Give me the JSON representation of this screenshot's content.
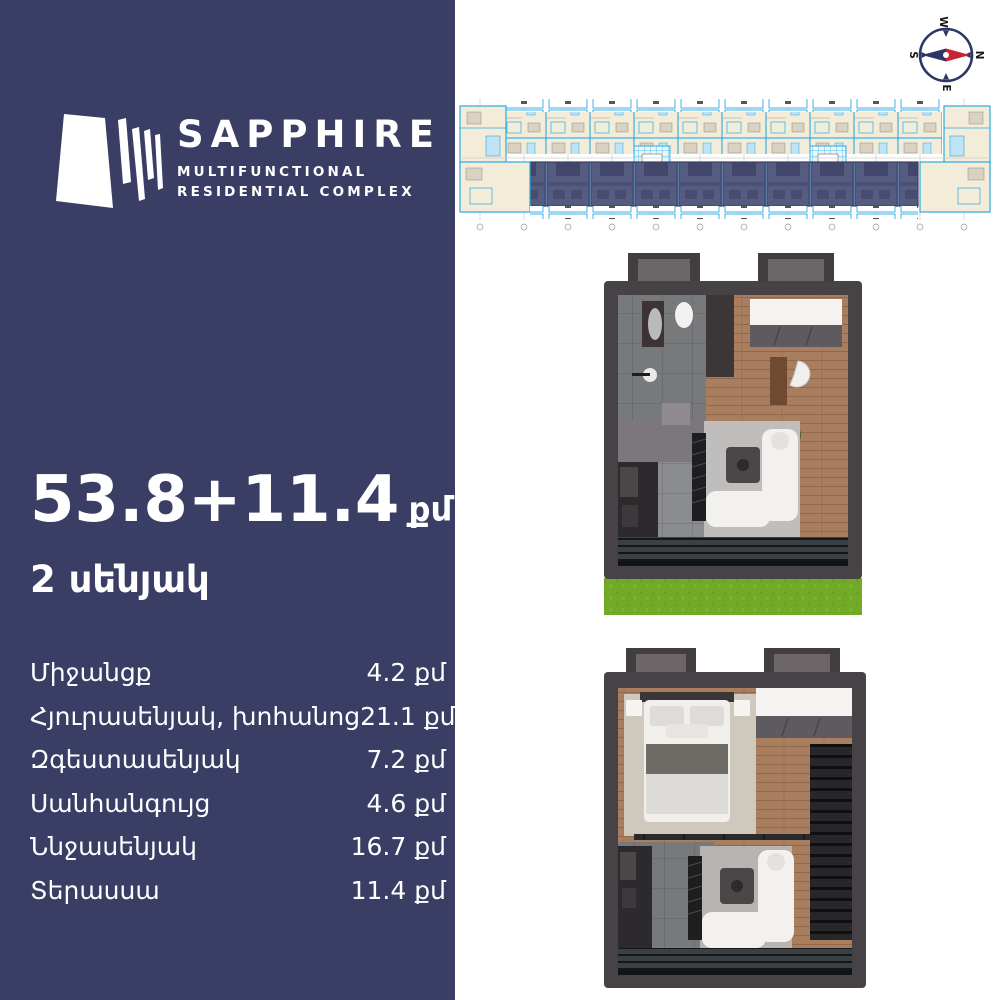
{
  "brand": {
    "name": "SAPPHIRE",
    "tagline1": "MULTIFUNCTIONAL",
    "tagline2": "RESIDENTIAL COMPLEX"
  },
  "listing": {
    "area_value": "53.8+11.4",
    "area_unit": "քմ",
    "rooms": "2 սենյակ"
  },
  "room_list": [
    {
      "label": "Միջանցք",
      "value": "4.2 քմ"
    },
    {
      "label": "Հյուրասենյակ, խոհանոց",
      "value": "21.1 քմ"
    },
    {
      "label": "Զգեստասենյակ",
      "value": "7.2 քմ"
    },
    {
      "label": "Սանհանգույց",
      "value": "4.6 քմ"
    },
    {
      "label": "Ննջասենյակ",
      "value": "16.7 քմ"
    },
    {
      "label": "Տերասսա",
      "value": "11.4 քմ"
    }
  ],
  "compass": {
    "top": "W",
    "right": "N",
    "bottom": "E",
    "left": "S"
  },
  "colors": {
    "panel_navy": "#3a3e64",
    "compass_navy": "#2c3863",
    "needle_red": "#c52631",
    "blueprint_cyan": "#29abe2",
    "blueprint_cream": "#f3ecd8",
    "highlight_navy": "#4b5076",
    "wood_brown": "#a87e5f",
    "grass_green": "#72aa28",
    "wall_gray": "#474245",
    "text_white": "#ffffff"
  }
}
